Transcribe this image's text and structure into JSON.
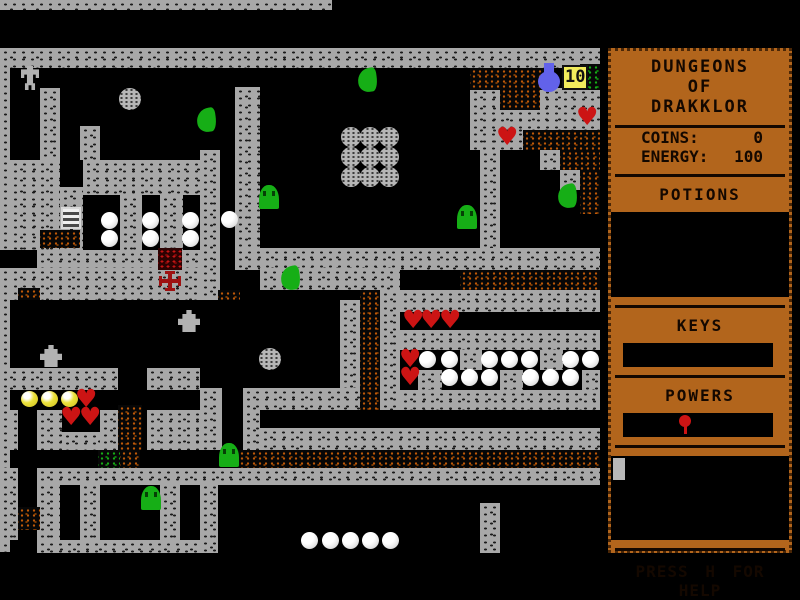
{
  "colors": {
    "bg": "#000000",
    "panel": "#b2651c",
    "panel_text": "#140800",
    "wall": "#a8a8a8",
    "wall_speck": "#1c1c1c",
    "rubble": "#c05a08",
    "rubble2": "#7a3a04",
    "green": "#16ae16",
    "green2": "#0c7c0c",
    "red_rubble": "#c41414",
    "heart": "#cc1414",
    "yellow": "#ece23c",
    "flask": "#6262ea",
    "badge_bg": "#f2ec5c",
    "gray_sprite": "#b2b2b2",
    "cross": "#9e1212"
  },
  "glyphs": {
    "heart": "♥"
  },
  "sidebar": {
    "title_lines": [
      "DUNGEONS",
      "OF",
      "DRAKKLOR"
    ],
    "stats": [
      {
        "label": "COINS:",
        "value": "0"
      },
      {
        "label": "ENERGY:",
        "value": "100"
      }
    ],
    "potions_header": "POTIONS",
    "keys_header": "KEYS",
    "powers_header": "POWERS",
    "help_text": "PRESS H FOR HELP"
  },
  "map": {
    "walls": [
      [
        0,
        0,
        332,
        10
      ],
      [
        0,
        48,
        600,
        20
      ],
      [
        0,
        68,
        10,
        182
      ],
      [
        0,
        268,
        10,
        284
      ],
      [
        40,
        88,
        20,
        72
      ],
      [
        80,
        126,
        20,
        34
      ],
      [
        10,
        160,
        50,
        35
      ],
      [
        83,
        160,
        117,
        35
      ],
      [
        10,
        195,
        50,
        55
      ],
      [
        60,
        187,
        23,
        63
      ],
      [
        120,
        195,
        22,
        55
      ],
      [
        160,
        195,
        23,
        55
      ],
      [
        200,
        150,
        20,
        150
      ],
      [
        235,
        87,
        25,
        161
      ],
      [
        480,
        150,
        20,
        98
      ],
      [
        235,
        248,
        365,
        22
      ],
      [
        260,
        268,
        140,
        22
      ],
      [
        37,
        250,
        121,
        18
      ],
      [
        182,
        250,
        18,
        18
      ],
      [
        10,
        268,
        190,
        32
      ],
      [
        470,
        88,
        130,
        62
      ],
      [
        540,
        150,
        20,
        20
      ],
      [
        560,
        170,
        20,
        20
      ],
      [
        0,
        368,
        118,
        22
      ],
      [
        147,
        368,
        53,
        22
      ],
      [
        10,
        410,
        8,
        40
      ],
      [
        37,
        410,
        25,
        40
      ],
      [
        100,
        410,
        18,
        40
      ],
      [
        147,
        410,
        53,
        40
      ],
      [
        62,
        432,
        38,
        18
      ],
      [
        340,
        300,
        20,
        88
      ],
      [
        380,
        290,
        20,
        120
      ],
      [
        200,
        388,
        22,
        62
      ],
      [
        243,
        388,
        117,
        22
      ],
      [
        243,
        410,
        17,
        40
      ],
      [
        260,
        428,
        340,
        22
      ],
      [
        400,
        290,
        200,
        22
      ],
      [
        400,
        330,
        200,
        20
      ],
      [
        460,
        350,
        22,
        20
      ],
      [
        540,
        350,
        23,
        20
      ],
      [
        418,
        370,
        24,
        20
      ],
      [
        500,
        370,
        23,
        20
      ],
      [
        582,
        370,
        18,
        20
      ],
      [
        400,
        390,
        200,
        20
      ],
      [
        0,
        468,
        18,
        15
      ],
      [
        37,
        468,
        563,
        17
      ],
      [
        37,
        483,
        23,
        70
      ],
      [
        80,
        483,
        20,
        70
      ],
      [
        160,
        483,
        20,
        70
      ],
      [
        200,
        483,
        18,
        70
      ],
      [
        0,
        483,
        18,
        57
      ],
      [
        37,
        540,
        163,
        13
      ],
      [
        480,
        503,
        20,
        50
      ]
    ],
    "rubble_orange": [
      [
        40,
        230,
        40,
        18
      ],
      [
        18,
        288,
        22,
        12
      ],
      [
        218,
        290,
        22,
        10
      ],
      [
        360,
        290,
        20,
        120
      ],
      [
        118,
        405,
        24,
        45
      ],
      [
        18,
        507,
        22,
        23
      ],
      [
        470,
        68,
        85,
        22
      ],
      [
        500,
        88,
        40,
        22
      ],
      [
        523,
        130,
        77,
        20
      ],
      [
        560,
        150,
        40,
        20
      ],
      [
        580,
        170,
        20,
        20
      ],
      [
        580,
        190,
        20,
        24
      ],
      [
        460,
        270,
        140,
        20
      ],
      [
        120,
        450,
        20,
        18
      ],
      [
        238,
        450,
        362,
        18
      ]
    ],
    "rubble_green": [
      [
        580,
        64,
        20,
        26
      ],
      [
        98,
        450,
        22,
        18
      ]
    ],
    "rubble_red": [
      [
        158,
        248,
        24,
        22
      ]
    ],
    "sprites": [
      {
        "t": "golem",
        "x": 21,
        "y": 66
      },
      {
        "t": "graypearl",
        "x": 119,
        "y": 88,
        "s": 22
      },
      {
        "t": "graypearl",
        "x": 259,
        "y": 348,
        "s": 22
      },
      {
        "t": "graypearl",
        "x": 341,
        "y": 127
      },
      {
        "t": "graypearl",
        "x": 360,
        "y": 127
      },
      {
        "t": "graypearl",
        "x": 379,
        "y": 127
      },
      {
        "t": "graypearl",
        "x": 341,
        "y": 147
      },
      {
        "t": "graypearl",
        "x": 360,
        "y": 147
      },
      {
        "t": "graypearl",
        "x": 379,
        "y": 147
      },
      {
        "t": "graypearl",
        "x": 341,
        "y": 167
      },
      {
        "t": "graypearl",
        "x": 360,
        "y": 167
      },
      {
        "t": "graypearl",
        "x": 379,
        "y": 167
      },
      {
        "t": "slug",
        "x": 358,
        "y": 68
      },
      {
        "t": "slug",
        "x": 197,
        "y": 108
      },
      {
        "t": "slug",
        "x": 558,
        "y": 184
      },
      {
        "t": "slug",
        "x": 281,
        "y": 266
      },
      {
        "t": "gumdrop",
        "x": 259,
        "y": 185
      },
      {
        "t": "gumdrop",
        "x": 457,
        "y": 205
      },
      {
        "t": "gumdrop",
        "x": 219,
        "y": 443
      },
      {
        "t": "gumdrop",
        "x": 141,
        "y": 486
      },
      {
        "t": "ladder",
        "x": 61,
        "y": 207
      },
      {
        "t": "cross",
        "x": 159,
        "y": 271
      },
      {
        "t": "hydrant",
        "x": 40,
        "y": 345
      },
      {
        "t": "hydrant",
        "x": 178,
        "y": 310
      },
      {
        "t": "flask",
        "x": 536,
        "y": 62
      },
      {
        "t": "badge",
        "x": 562,
        "y": 65,
        "text": "10"
      },
      {
        "t": "yellowball",
        "x": 21,
        "y": 391
      },
      {
        "t": "yellowball",
        "x": 41,
        "y": 391
      },
      {
        "t": "yellowball",
        "x": 61,
        "y": 391
      },
      {
        "t": "heart",
        "x": 75,
        "y": 390
      },
      {
        "t": "heart",
        "x": 60,
        "y": 408
      },
      {
        "t": "heart",
        "x": 79,
        "y": 408
      },
      {
        "t": "heart",
        "x": 402,
        "y": 311
      },
      {
        "t": "heart",
        "x": 420,
        "y": 311
      },
      {
        "t": "heart",
        "x": 439,
        "y": 311
      },
      {
        "t": "heart",
        "x": 399,
        "y": 350
      },
      {
        "t": "heart",
        "x": 399,
        "y": 368
      },
      {
        "t": "heart",
        "x": 576,
        "y": 108
      },
      {
        "t": "heart",
        "x": 496,
        "y": 128
      },
      {
        "t": "pearl",
        "x": 101,
        "y": 212
      },
      {
        "t": "pearl",
        "x": 101,
        "y": 230
      },
      {
        "t": "pearl",
        "x": 142,
        "y": 212
      },
      {
        "t": "pearl",
        "x": 142,
        "y": 230
      },
      {
        "t": "pearl",
        "x": 182,
        "y": 212
      },
      {
        "t": "pearl",
        "x": 182,
        "y": 230
      },
      {
        "t": "pearl",
        "x": 221,
        "y": 211
      },
      {
        "t": "pearl",
        "x": 419,
        "y": 351
      },
      {
        "t": "pearl",
        "x": 441,
        "y": 351
      },
      {
        "t": "pearl",
        "x": 481,
        "y": 351
      },
      {
        "t": "pearl",
        "x": 501,
        "y": 351
      },
      {
        "t": "pearl",
        "x": 521,
        "y": 351
      },
      {
        "t": "pearl",
        "x": 562,
        "y": 351
      },
      {
        "t": "pearl",
        "x": 582,
        "y": 351
      },
      {
        "t": "pearl",
        "x": 441,
        "y": 369
      },
      {
        "t": "pearl",
        "x": 461,
        "y": 369
      },
      {
        "t": "pearl",
        "x": 481,
        "y": 369
      },
      {
        "t": "pearl",
        "x": 522,
        "y": 369
      },
      {
        "t": "pearl",
        "x": 542,
        "y": 369
      },
      {
        "t": "pearl",
        "x": 562,
        "y": 369
      },
      {
        "t": "pearl",
        "x": 301,
        "y": 532
      },
      {
        "t": "pearl",
        "x": 322,
        "y": 532
      },
      {
        "t": "pearl",
        "x": 342,
        "y": 532
      },
      {
        "t": "pearl",
        "x": 362,
        "y": 532
      },
      {
        "t": "pearl",
        "x": 382,
        "y": 532
      }
    ]
  }
}
